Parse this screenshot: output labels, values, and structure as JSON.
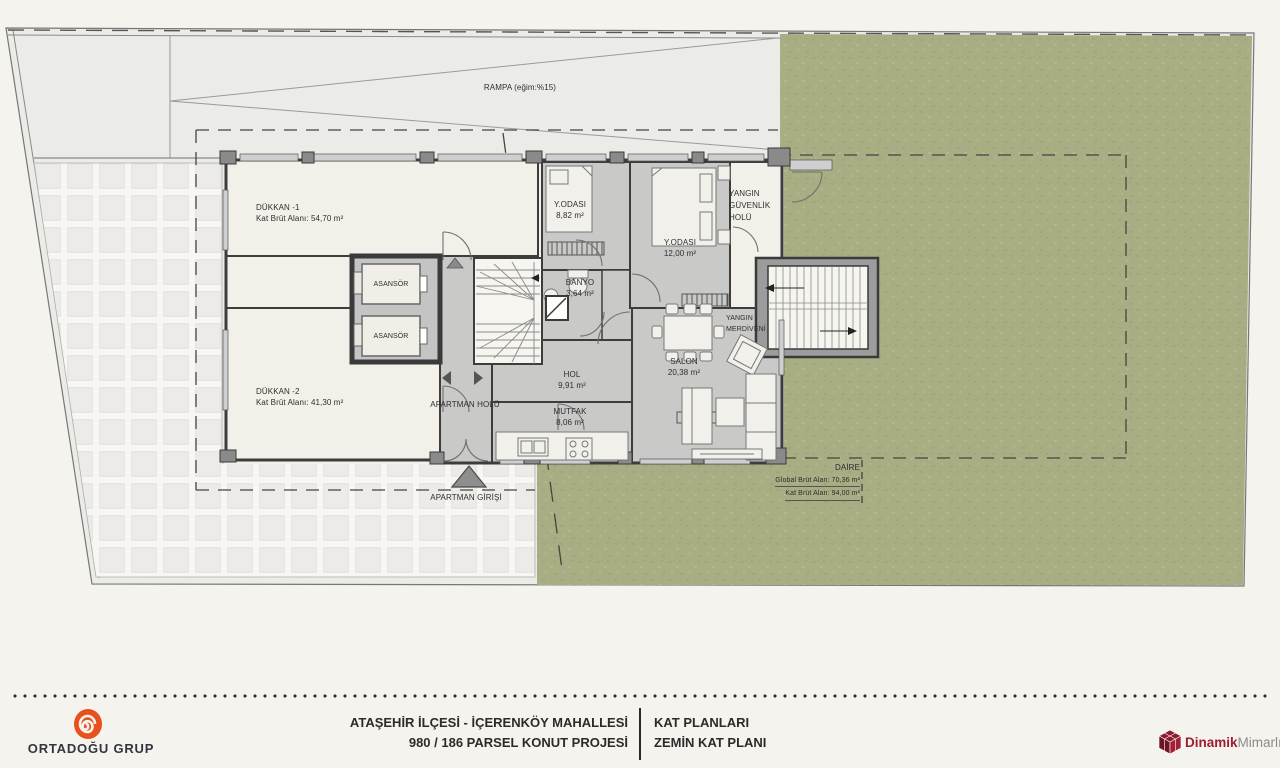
{
  "plan": {
    "ramp": "RAMPA (eğim:%15)",
    "rooms": {
      "dukkan1_name": "DÜKKAN -1",
      "dukkan1_area": "Kat Brüt Alanı: 54,70 m²",
      "dukkan2_name": "DÜKKAN -2",
      "dukkan2_area": "Kat Brüt Alanı: 41,30 m²",
      "asansor": "ASANSÖR",
      "yodasi1_name": "Y.ODASI",
      "yodasi1_area": "8,82 m²",
      "yodasi2_name": "Y.ODASI",
      "yodasi2_area": "12,00 m²",
      "banyo_name": "BANYO",
      "banyo_area": "3,64 m²",
      "hol_name": "HOL",
      "hol_area": "9,91 m²",
      "mutfak_name": "MUTFAK",
      "mutfak_area": "8,06 m²",
      "salon_name": "SALON",
      "salon_area": "20,38 m²",
      "apartman_holu": "APARTMAN HOLÜ",
      "yangin_guvenlik_holu": "YANGIN GÜVENLİK HOLÜ",
      "yangin_merdiveni": "YANGIN MERDİVENİ",
      "apartman_girisi": "APARTMAN GİRİŞİ"
    },
    "daire": {
      "title": "DAİRE",
      "global_brut": "Global Brüt Alan: 70,36 m²",
      "kat_brut": "Kat Brüt Alan: 94,00 m²"
    }
  },
  "titlebar": {
    "left_logo": "ORTADOĞU GRUP",
    "location_line1": "ATAŞEHİR İLÇESİ - İÇERENKÖY MAHALLESİ",
    "location_line2": "980 / 186 PARSEL  KONUT PROJESİ",
    "plan_line1": "KAT PLANLARI",
    "plan_line2": "ZEMİN KAT PLANI",
    "right_logo_primary": "Dinamik",
    "right_logo_secondary": "Mimarlık"
  },
  "icons": {
    "left_logo": "spiral-icon",
    "right_logo": "cube-icon",
    "entrance": "triangle-arrow-icon"
  },
  "colors": {
    "grass_green": "#a9ad83",
    "accent_orange": "#e8511d",
    "logo_red": "#9e1c30",
    "room_gray": "#c9c9c8",
    "room_cream": "#f2f0e9"
  }
}
